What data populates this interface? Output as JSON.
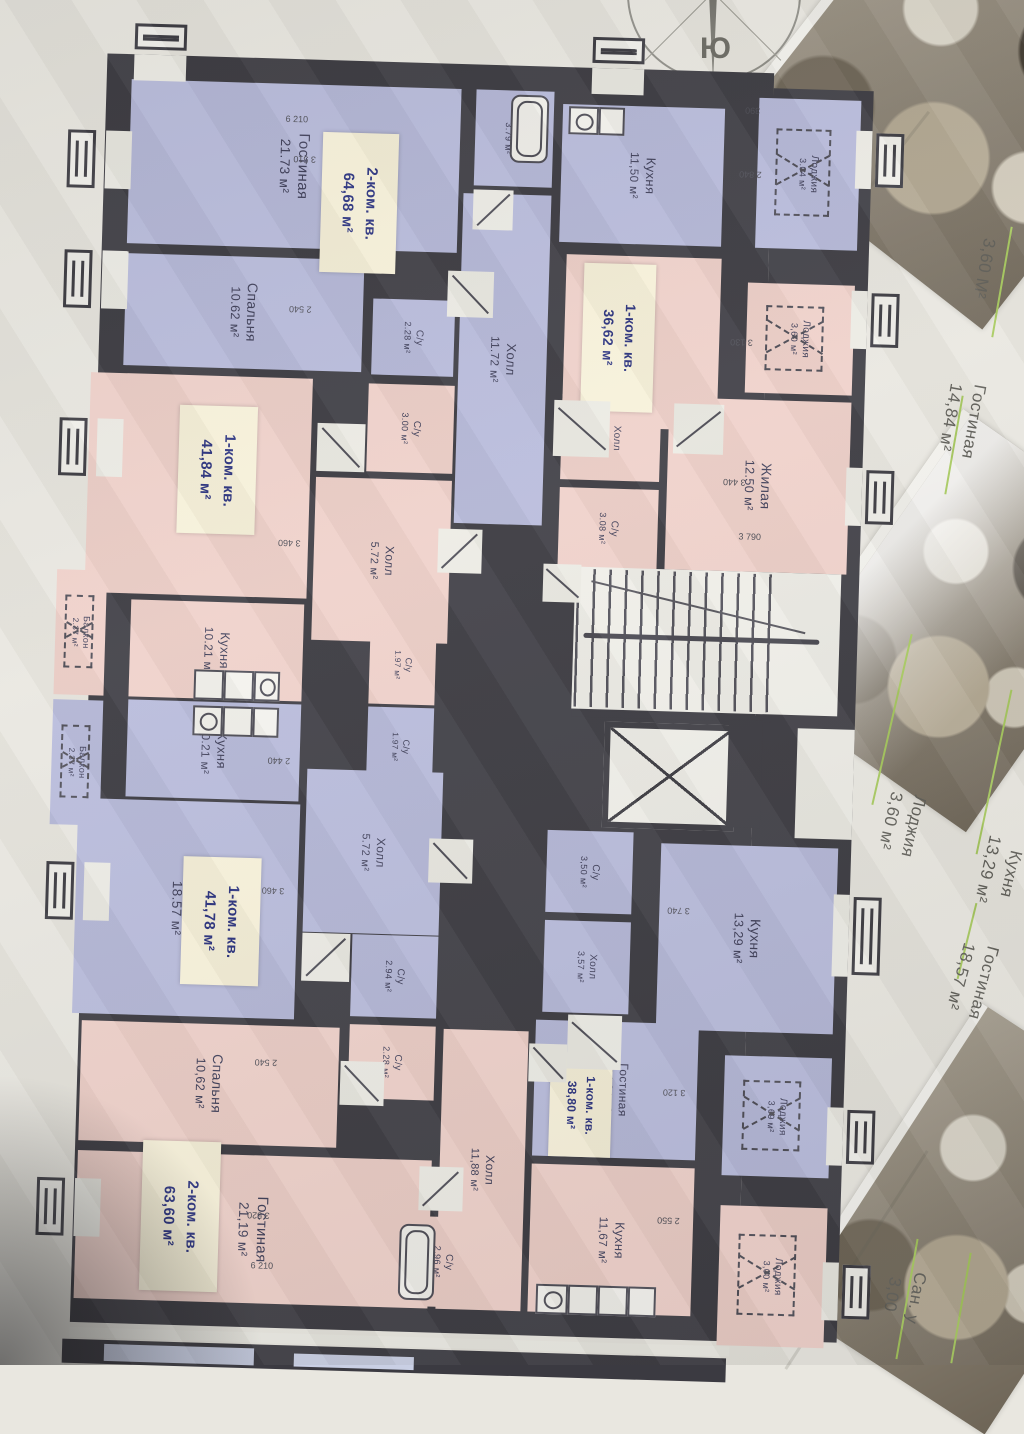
{
  "compass": {
    "label": "Ю"
  },
  "palette": {
    "wall_color": "#3b3a41",
    "fill_blue": "#b7badb",
    "fill_pink": "#efd0c9",
    "label_box_bg": "#f8f2da",
    "label_text_color": "#28307f",
    "leader_green": "#a6c95c",
    "paper": "#e9e7e0"
  },
  "apartments": [
    {
      "id": "apt-2k-6468",
      "type": "2-ком. кв.",
      "area": "64,68 м²",
      "color": "blue",
      "rooms": [
        {
          "name": "Гостиная",
          "area": "21.73 м²"
        },
        {
          "name": "Спальня",
          "area": "10.62 м²"
        },
        {
          "name": "Холл",
          "area": "11.72 м²"
        },
        {
          "name": "Кухня",
          "area": "11,50 м²"
        },
        {
          "name": "С/у",
          "area": "3.79 м²"
        },
        {
          "name": "С/у",
          "area": "2.28 м²"
        },
        {
          "name": "Лоджия",
          "area": "3.04 м²"
        }
      ]
    },
    {
      "id": "apt-1k-3662",
      "type": "1-ком. кв.",
      "area": "36,62 м²",
      "color": "pink",
      "rooms": [
        {
          "name": "Кухня Столовая",
          "area": "14.26 м²"
        },
        {
          "name": "Жилая",
          "area": "12.50 м²"
        },
        {
          "name": "Холл",
          "area": "3.18 м²"
        },
        {
          "name": "С/у",
          "area": "3.08 м²"
        },
        {
          "name": "Лоджия",
          "area": "3,60 м²"
        }
      ]
    },
    {
      "id": "apt-1k-4184",
      "type": "1-ком. кв.",
      "area": "41,84 м²",
      "color": "pink",
      "rooms": [
        {
          "name": "Гостиная",
          "area": "18.57 м²"
        },
        {
          "name": "Кухня",
          "area": "10.21 м²"
        },
        {
          "name": "Холл",
          "area": "5.72 м²"
        },
        {
          "name": "С/у",
          "area": "3.00 м²"
        },
        {
          "name": "С/у",
          "area": "1.97 м²"
        },
        {
          "name": "Балкон",
          "area": "2.37 м²"
        }
      ]
    },
    {
      "id": "apt-1k-4178",
      "type": "1-ком. кв.",
      "area": "41,78 м²",
      "color": "blue",
      "rooms": [
        {
          "name": "Гостиная",
          "area": "18.57 м²"
        },
        {
          "name": "Кухня",
          "area": "10.21 м²"
        },
        {
          "name": "Холл",
          "area": "5.72 м²"
        },
        {
          "name": "С/у",
          "area": "2.94 м²"
        },
        {
          "name": "С/у",
          "area": "1.97 м²"
        },
        {
          "name": "Балкон",
          "area": "2.37 м²"
        }
      ]
    },
    {
      "id": "apt-2k-6360",
      "type": "2-ком. кв.",
      "area": "63,60 м²",
      "color": "pink",
      "rooms": [
        {
          "name": "Спальня",
          "area": "10,62 м²"
        },
        {
          "name": "Гостиная",
          "area": "21,19 м²"
        },
        {
          "name": "Холл",
          "area": "11,88 м²"
        },
        {
          "name": "Кухня",
          "area": "11,67 м²"
        },
        {
          "name": "С/у",
          "area": "2.28 м²"
        },
        {
          "name": "С/у",
          "area": "2.96 м²"
        },
        {
          "name": "Лоджия",
          "area": "3,00 м²"
        }
      ]
    },
    {
      "id": "apt-1k-3880",
      "type": "1-ком. кв.",
      "area": "38,80 м²",
      "color": "blue",
      "rooms": [
        {
          "name": "Гостиная",
          "area": "14,84 м²"
        },
        {
          "name": "Кухня",
          "area": "13,29 м²"
        },
        {
          "name": "Холл",
          "area": "3,57 м²"
        },
        {
          "name": "С/у",
          "area": "3,50 м²"
        },
        {
          "name": "Лоджия",
          "area": "3,69 м²"
        }
      ]
    }
  ],
  "dimensions": [
    "6 210",
    "3 510",
    "2 540",
    "3 460",
    "2 440",
    "3 460",
    "2 540",
    "3 520",
    "6 210",
    "390",
    "2 840",
    "3 130",
    "3 440",
    "3 790",
    "3 740",
    "3 120",
    "2 550"
  ],
  "side_page_labels": [
    {
      "name": "Гостиная",
      "area": "12,50 м²"
    },
    {
      "name": "",
      "area": "3,60 М²"
    },
    {
      "name": "Гостиная",
      "area": "14,84 м²"
    },
    {
      "name": "Лоджия",
      "area": "3,60 м²"
    },
    {
      "name": "Кухня",
      "area": "13,29 м²"
    },
    {
      "name": "Гостиная",
      "area": "18,57 м²"
    },
    {
      "name": "Сан. у",
      "area": "3,00"
    }
  ]
}
